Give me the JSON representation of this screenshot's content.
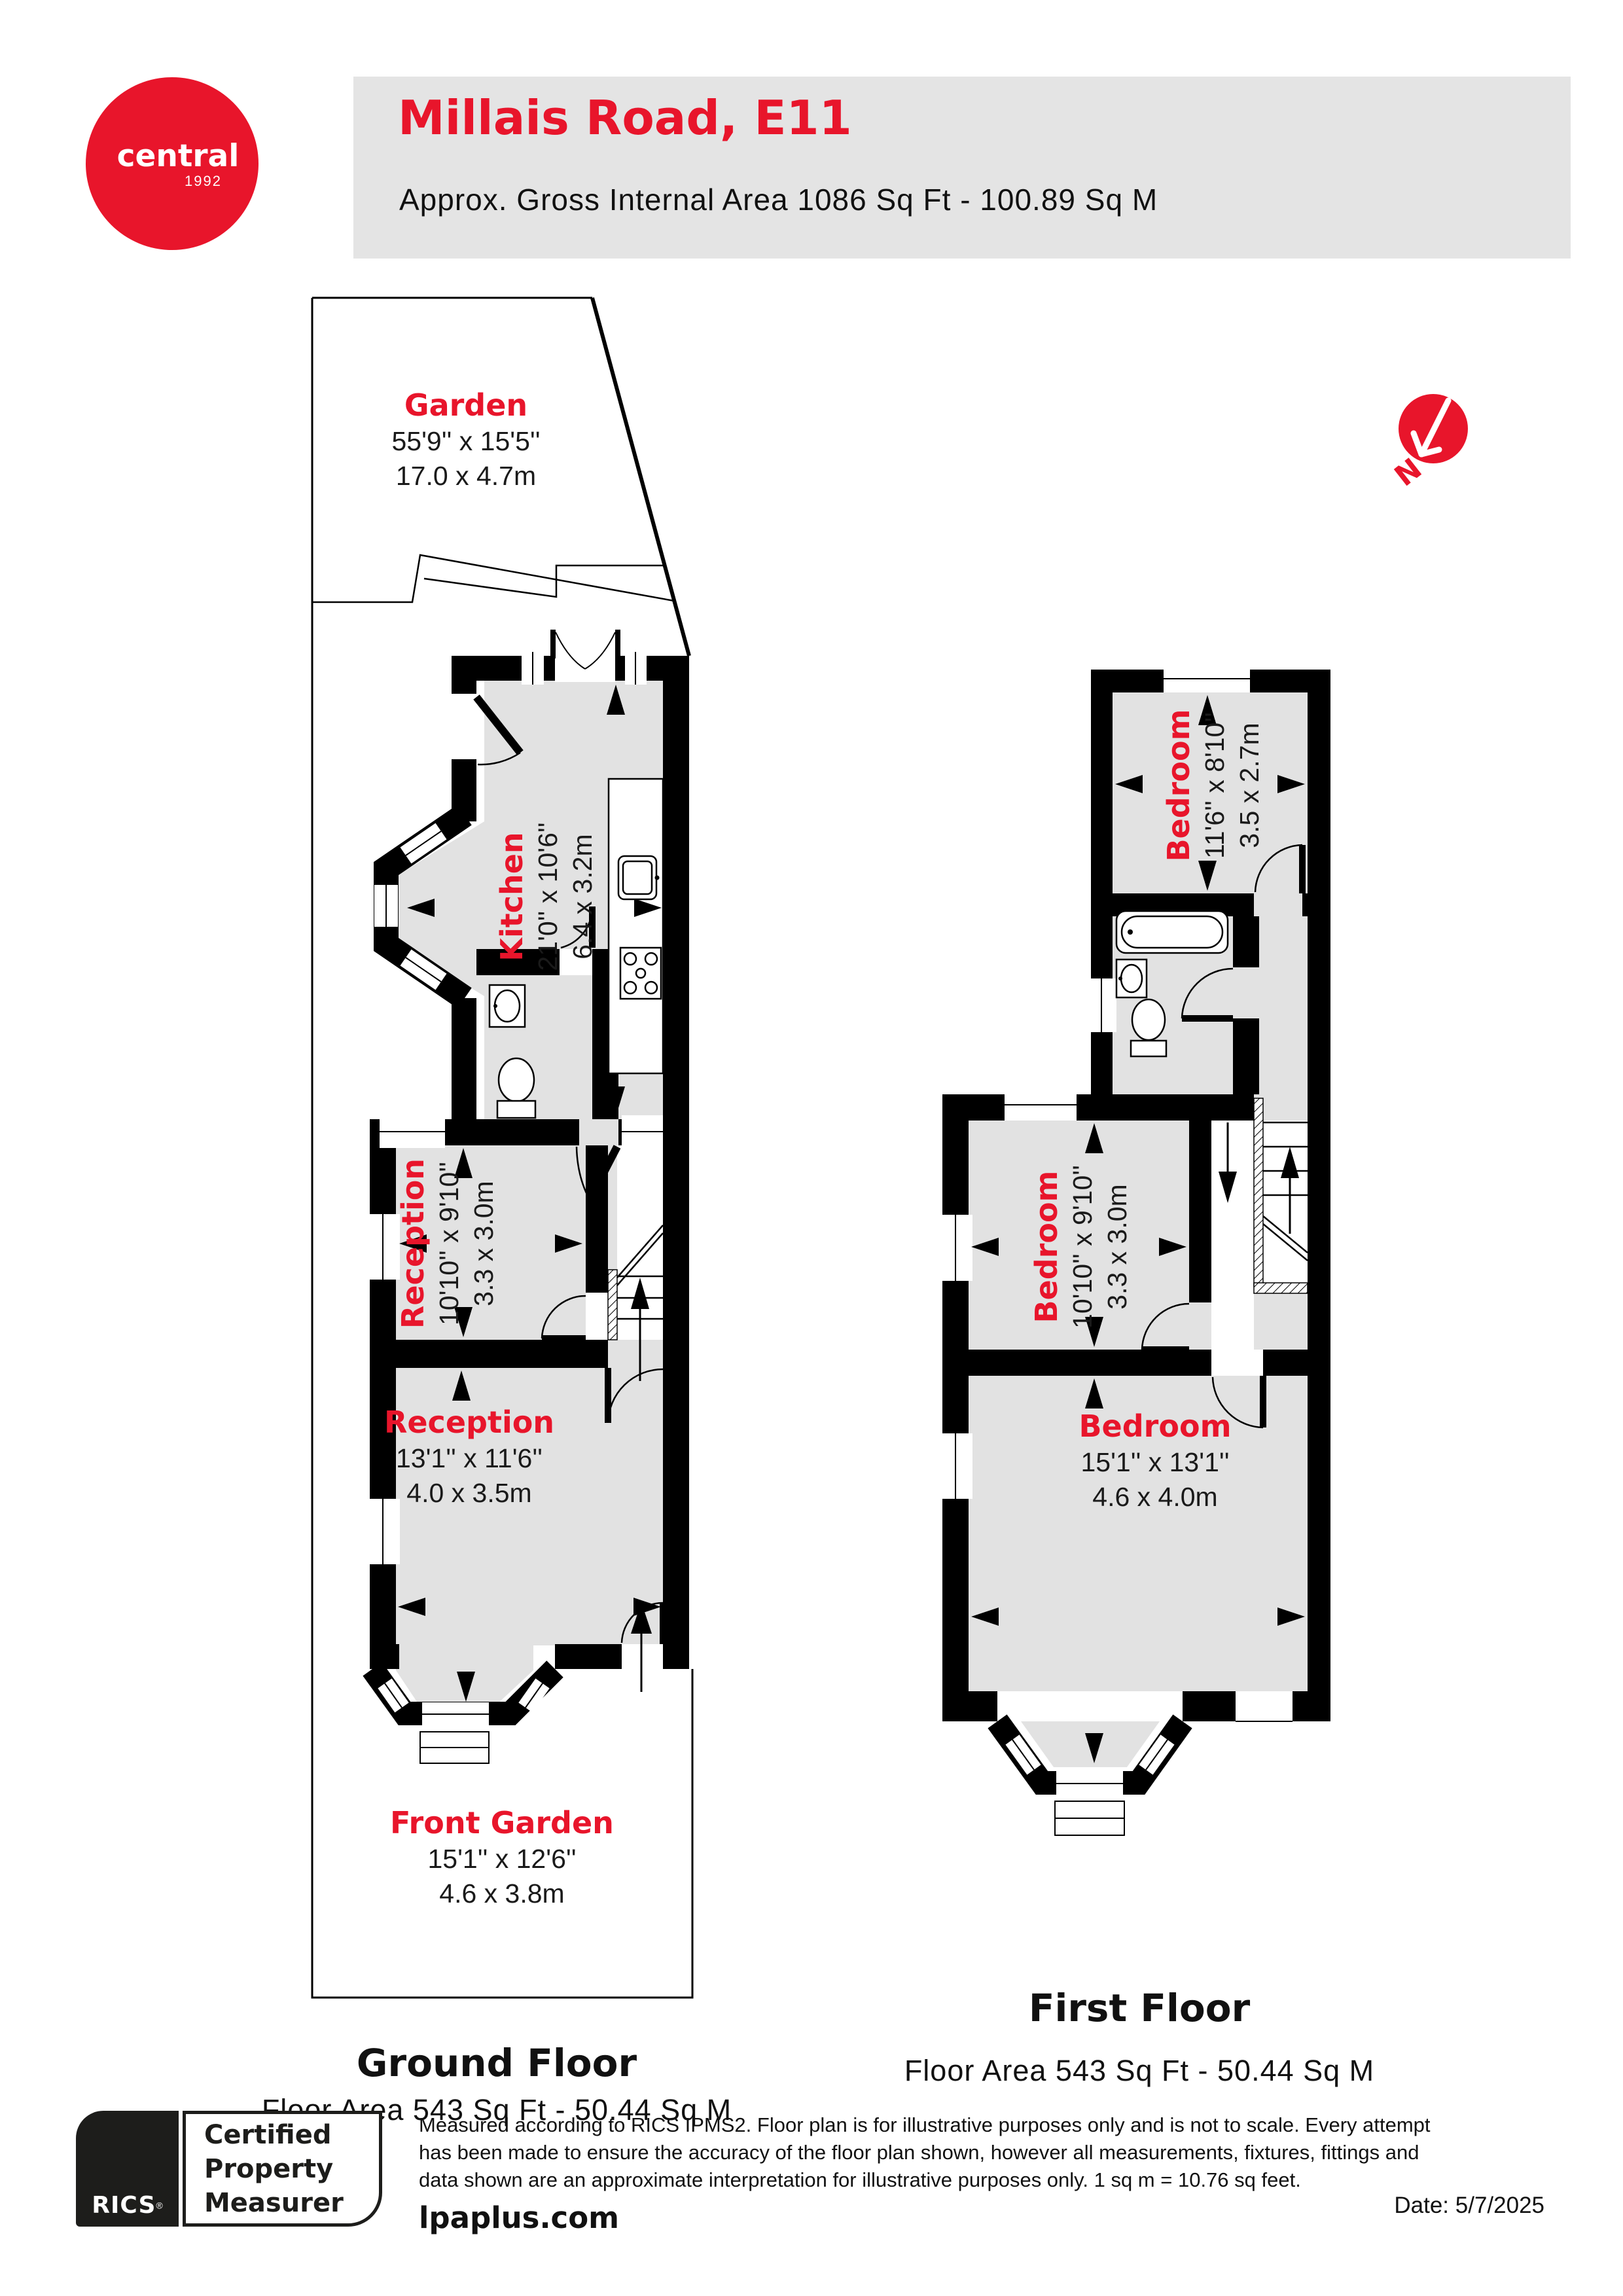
{
  "header": {
    "logo_line1": "central",
    "logo_line2": "1992",
    "title": "Millais Road, E11",
    "subtitle": "Approx. Gross Internal Area 1086 Sq Ft - 100.89 Sq M"
  },
  "compass": {
    "north_label": "N"
  },
  "ground_floor": {
    "title": "Ground Floor",
    "area": "Floor Area 543 Sq Ft - 50.44 Sq M",
    "rooms": {
      "garden": {
        "name": "Garden",
        "dim_ft": "55'9'' x 15'5''",
        "dim_m": "17.0 x 4.7m"
      },
      "kitchen": {
        "name": "Kitchen",
        "dim_ft": "21'0'' x 10'6''",
        "dim_m": "6.4 x 3.2m"
      },
      "reception1": {
        "name": "Reception",
        "dim_ft": "10'10'' x 9'10''",
        "dim_m": "3.3 x 3.0m"
      },
      "reception2": {
        "name": "Reception",
        "dim_ft": "13'1'' x 11'6''",
        "dim_m": "4.0 x 3.5m"
      },
      "front_garden": {
        "name": "Front Garden",
        "dim_ft": "15'1'' x 12'6''",
        "dim_m": "4.6 x 3.8m"
      }
    }
  },
  "first_floor": {
    "title": "First Floor",
    "area": "Floor Area 543 Sq Ft - 50.44 Sq M",
    "rooms": {
      "bedroom_rear": {
        "name": "Bedroom",
        "dim_ft": "11'6'' x 8'10''",
        "dim_m": "3.5 x 2.7m"
      },
      "bedroom_middle": {
        "name": "Bedroom",
        "dim_ft": "10'10'' x 9'10''",
        "dim_m": "3.3 x 3.0m"
      },
      "bedroom_front": {
        "name": "Bedroom",
        "dim_ft": "15'1'' x 13'1''",
        "dim_m": "4.6 x 4.0m"
      }
    }
  },
  "footer": {
    "rics_word": "RICS",
    "rics_reg": "®",
    "badge_line1": "Certified",
    "badge_line2": "Property",
    "badge_line3": "Measurer",
    "disclaimer_line1": "Measured according to RICS IPMS2. Floor plan is for illustrative purposes only and is not to scale. Every attempt",
    "disclaimer_line2": "has been made to ensure the accuracy of the floor plan shown, however all measurements, fixtures, fittings and",
    "disclaimer_line3": "data shown are an approximate interpretation for illustrative purposes only. 1 sq m = 10.76 sq feet.",
    "website": "lpaplus.com",
    "date": "Date: 5/7/2025"
  },
  "colors": {
    "accent_red": "#e8152b",
    "room_fill": "#e2e2e2",
    "wall_black": "#000000",
    "header_gray": "#e4e4e4"
  }
}
